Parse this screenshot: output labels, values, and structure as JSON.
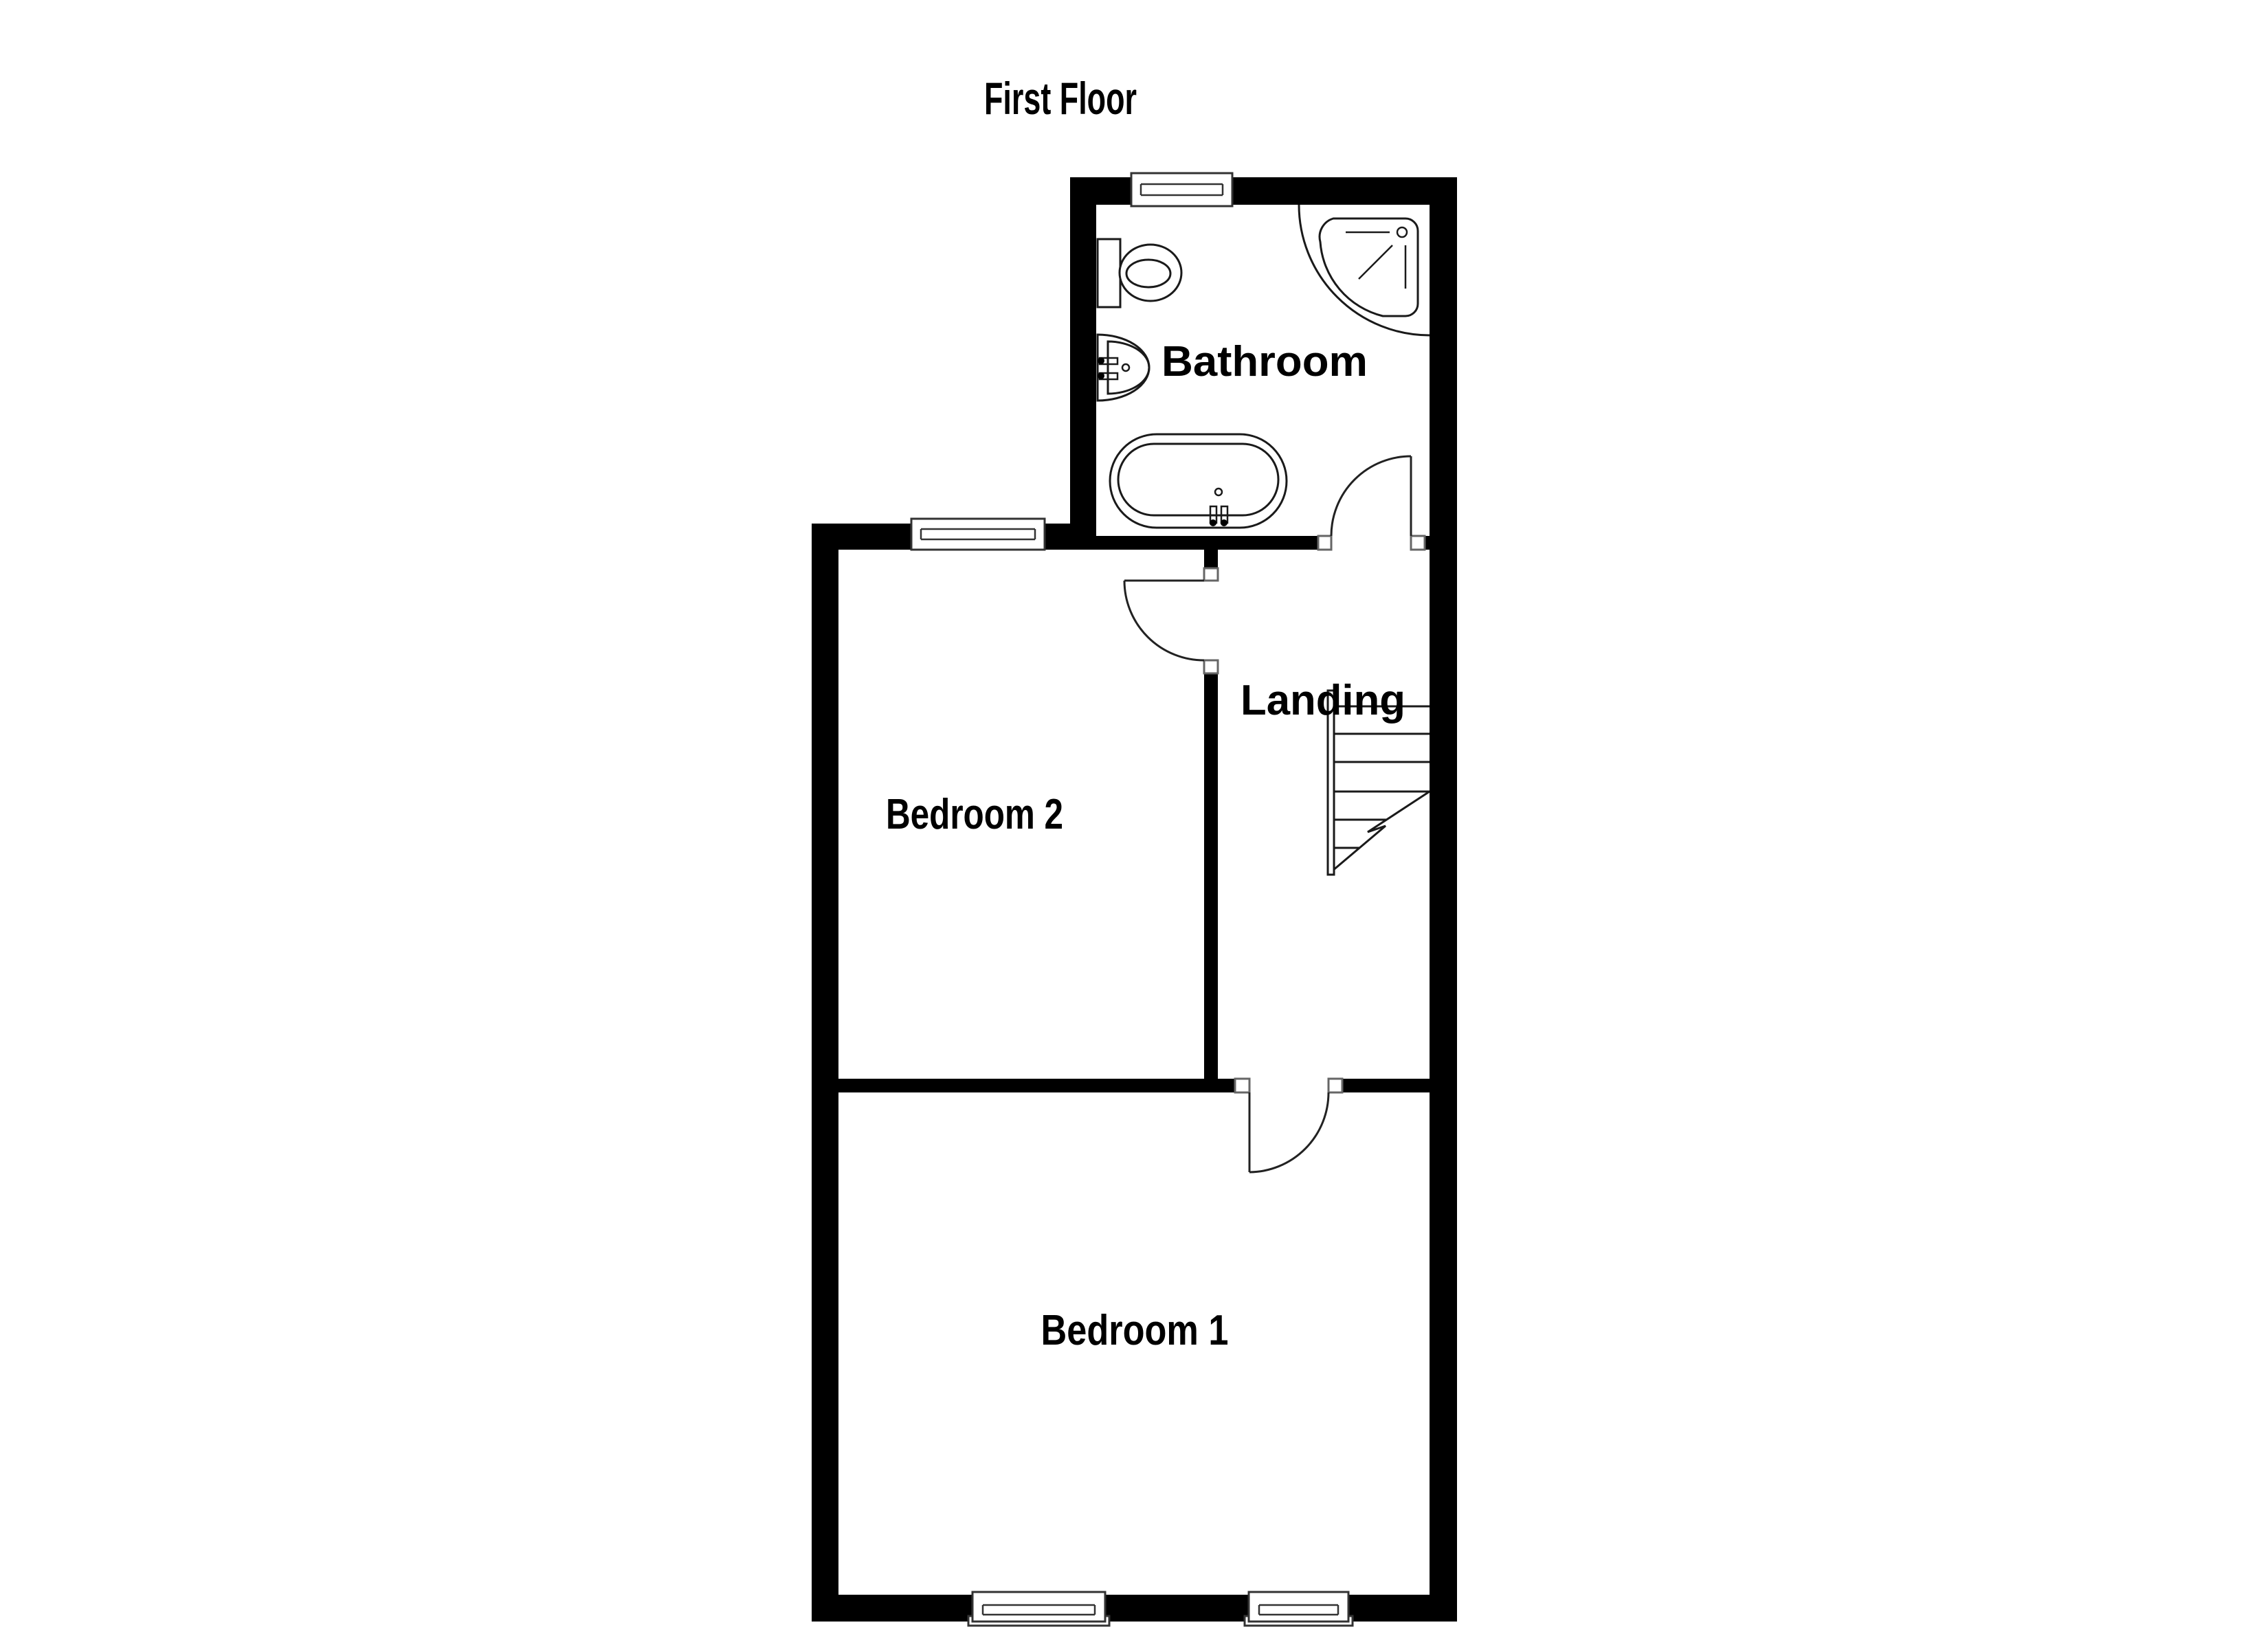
{
  "title": "First Floor",
  "rooms": {
    "bathroom": {
      "label": "Bathroom"
    },
    "landing": {
      "label": "Landing"
    },
    "bedroom2": {
      "label": "Bedroom 2"
    },
    "bedroom1": {
      "label": "Bedroom 1"
    }
  },
  "fixtures": {
    "bathroom": [
      "toilet",
      "sink",
      "corner-shower",
      "bathtub"
    ],
    "landing": [
      "staircase"
    ]
  },
  "counts": {
    "windows": 4,
    "doors": 4
  },
  "colors": {
    "wall": "#000000",
    "background": "#ffffff",
    "line": "#1a1a1a"
  }
}
